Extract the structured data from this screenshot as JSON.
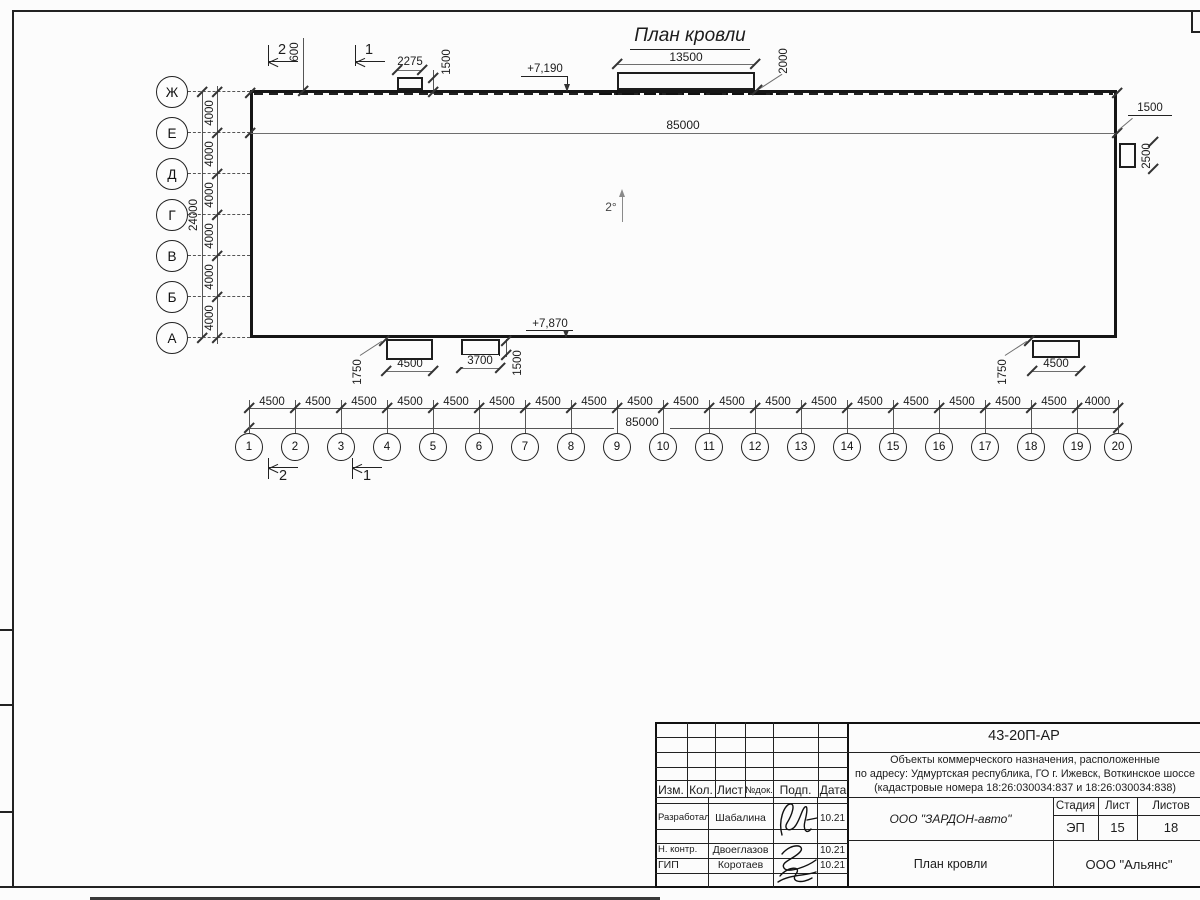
{
  "sheet": {
    "title": "План кровли"
  },
  "plan": {
    "row_axes": [
      "Ж",
      "Е",
      "Д",
      "Г",
      "В",
      "Б",
      "А"
    ],
    "row_bay": "4000",
    "row_total": "24000",
    "col_axes": [
      "1",
      "2",
      "3",
      "4",
      "5",
      "6",
      "7",
      "8",
      "9",
      "10",
      "11",
      "12",
      "13",
      "14",
      "15",
      "16",
      "17",
      "18",
      "19",
      "20"
    ],
    "col_bays": [
      "4500",
      "4500",
      "4500",
      "4500",
      "4500",
      "4500",
      "4500",
      "4500",
      "4500",
      "4500",
      "4500",
      "4500",
      "4500",
      "4500",
      "4500",
      "4500",
      "4500",
      "4500",
      "4000"
    ],
    "col_total": "85000",
    "slope": "2°",
    "sections": {
      "one": "1",
      "two": "2"
    },
    "dims": {
      "total_top": "85000",
      "d600": "600",
      "d2275": "2275",
      "d1500_tl": "1500",
      "d13500": "13500",
      "d2000": "2000",
      "elev_top": "+7,190",
      "d1500_tr": "1500",
      "d2500": "2500",
      "elev_bot": "+7,870",
      "d1750_l": "1750",
      "d4500_l": "4500",
      "d3700": "3700",
      "d1500_b": "1500",
      "d1750_r": "1750",
      "d4500_r": "4500"
    }
  },
  "stamp": {
    "doc_number": "43-20П-АР",
    "project_line1": "Объекты коммерческого назначения, расположенные",
    "project_line2": "по адресу: Удмуртская республика, ГО г. Ижевск, Воткинское шоссе",
    "project_line3": "(кадастровые номера 18:26:030034:837 и 18:26:030034:838)",
    "header_cols": [
      "Изм.",
      "Кол.",
      "Лист",
      "№док.",
      "Подп.",
      "Дата"
    ],
    "rows": [
      {
        "role": "Разработал",
        "name": "Шабалина",
        "date": "10.21"
      },
      {
        "role": "Н. контр.",
        "name": "Двоеглазов",
        "date": "10.21"
      },
      {
        "role": "ГИП",
        "name": "Коротаев",
        "date": "10.21"
      }
    ],
    "company": "ООО \"ЗАРДОН-авто\"",
    "stage_label": "Стадия",
    "sheet_label": "Лист",
    "sheets_label": "Листов",
    "stage": "ЭП",
    "sheet_no": "15",
    "sheets_total": "18",
    "drawing_title": "План кровли",
    "contractor": "ООО \"Альянс\""
  }
}
